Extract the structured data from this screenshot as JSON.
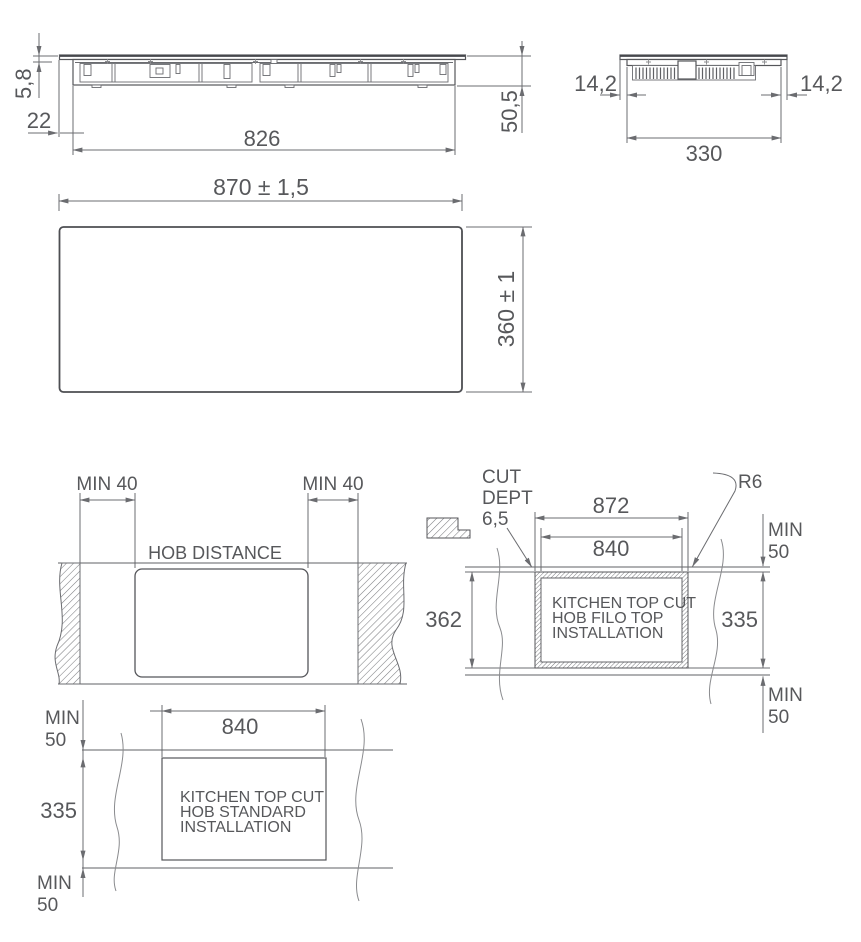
{
  "drawing_title": "Hob installation dimensions",
  "colors": {
    "ink": "#57585b",
    "outline": "#55565a",
    "dim_line": "#6b6c70",
    "light": "#8a8b8e"
  },
  "views": {
    "side": {
      "glass_thickness": "5,8",
      "edge_overhang": "22",
      "body_width": "826",
      "total_height": "50,5"
    },
    "end": {
      "inset_left": "14,2",
      "inset_right": "14,2",
      "body_depth": "330"
    },
    "top": {
      "overall_width": "870 ± 1,5",
      "overall_depth": "360 ± 1"
    },
    "hob_distance": {
      "title": "HOB DISTANCE",
      "min_left": "MIN 40",
      "min_right": "MIN 40"
    },
    "filo": {
      "cut_note_line1": "CUT",
      "cut_note_line2": "DEPT",
      "cut_note_line3": "6,5",
      "corner_radius": "R6",
      "outer_cut_width": "872",
      "inner_cut_width": "840",
      "outer_cut_depth": "362",
      "inner_cut_depth": "335",
      "min_top_line1": "MIN",
      "min_top_line2": "50",
      "min_bottom_line1": "MIN",
      "min_bottom_line2": "50",
      "label_line1": "KITCHEN TOP CUT",
      "label_line2": "HOB FILO TOP",
      "label_line3": "INSTALLATION"
    },
    "standard": {
      "min_top_line1": "MIN",
      "min_top_line2": "50",
      "cut_width": "840",
      "cut_depth": "335",
      "min_bottom_line1": "MIN",
      "min_bottom_line2": "50",
      "label_line1": "KITCHEN TOP CUT",
      "label_line2": "HOB STANDARD",
      "label_line3": "INSTALLATION"
    }
  }
}
